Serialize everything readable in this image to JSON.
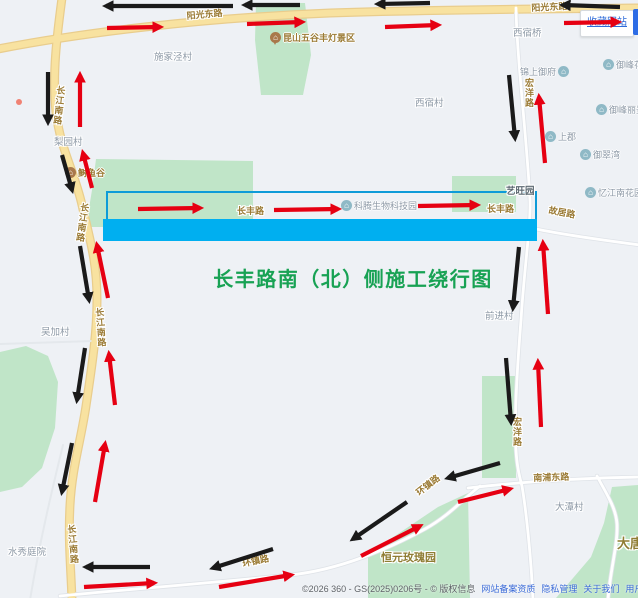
{
  "title": {
    "text": "长丰路南（北）侧施工绕行图"
  },
  "bookmark": {
    "label": "收藏网站"
  },
  "footer": {
    "copyright": "©2026 360 - GS(2025)0206号 - © 版权信息",
    "links": [
      "网站备案资质",
      "隐私管理",
      "关于我们",
      "用户协议",
      "意见反馈"
    ]
  },
  "colors": {
    "bg": "#eef1f5",
    "road_main_fill": "#f8e2a0",
    "road_main_casing": "#e9cd8d",
    "road_minor_fill": "#ffffff",
    "road_minor_casing": "#dfe3e8",
    "road_faint": "#e4e8ec",
    "green_area": "#c0e5c8",
    "highlight_fill": "#00aff0",
    "highlight_outline": "#0e9bd8",
    "arrow_red": "#e60012",
    "arrow_black": "#1a1a1a",
    "road_label": "#9b7b35",
    "village_label": "#8d99a6",
    "brown_label": "#8f7d33",
    "title_green": "#18a254",
    "link_blue": "#3b6bd8",
    "poi_icon": "#8fb9c6",
    "scenic_icon": "#a9784b",
    "red_dot": "#f08273"
  },
  "map": {
    "areas": [
      {
        "points": "256,3 305,3 311,55 303,95 261,95 255,40"
      },
      {
        "points": "96,159 253,161 253,227 86,227 92,190"
      },
      {
        "points": "452,176 516,176 516,212 452,212"
      },
      {
        "points": "0,352 26,346 48,356 58,382 55,428 42,468 22,487 0,492"
      },
      {
        "points": "482,376 516,376 516,478 482,478"
      },
      {
        "points": "368,554 438,507 468,493 470,598 368,598"
      },
      {
        "points": "612,487 638,485 638,598 556,598 591,557 604,523"
      }
    ],
    "roads": [
      {
        "type": "main",
        "d": "M62,-2 C57,35 52,75 56,112 C60,148 74,170 82,205 C90,240 97,262 97,300 C97,335 91,372 86,406 C81,440 72,468 70,505 C68,540 71,570 72,600"
      },
      {
        "type": "main",
        "d": "M-2,49 C80,33 200,18 330,13 C450,9 560,9 640,8"
      },
      {
        "type": "minor",
        "d": "M516,8 C517,60 527,140 530,200 C531,225 524,270 521,320 C517,370 514,420 516,450 C517,468 520,478 522,486 C526,510 531,555 533,600"
      },
      {
        "type": "minor",
        "d": "M536,229 C570,236 610,241 640,245"
      },
      {
        "type": "minor",
        "d": "M468,488 C520,482 580,478 640,477"
      },
      {
        "type": "minor",
        "d": "M60,596 C120,590 200,584 290,575 C340,570 390,548 425,529 C450,515 463,499 480,486"
      },
      {
        "type": "minor",
        "d": "M597,476 C607,495 616,508 617,524 C618,545 610,570 608,600"
      },
      {
        "type": "faint",
        "d": "M63,445 C52,490 40,540 30,600"
      },
      {
        "type": "faint",
        "d": "M0,344 L93,341"
      }
    ],
    "highlight": {
      "outline": {
        "x": 107,
        "y": 192,
        "w": 429,
        "h": 29
      },
      "bar": {
        "x": 103,
        "y": 219,
        "w": 434,
        "h": 22
      }
    },
    "red_dot": {
      "x": 19,
      "y": 102
    },
    "labels": [
      {
        "t": "阳光东路",
        "x": 186,
        "y": 9,
        "type": "road",
        "rot": -5
      },
      {
        "t": "阳光东路",
        "x": 531,
        "y": 1,
        "type": "road",
        "rot": -3
      },
      {
        "t": "长江南路",
        "x": 55,
        "y": 85,
        "type": "road",
        "v": true,
        "rot": 6
      },
      {
        "t": "长江南路",
        "x": 79,
        "y": 202,
        "type": "road",
        "v": true,
        "rot": 8
      },
      {
        "t": "长江南路",
        "x": 93,
        "y": 308,
        "type": "road",
        "v": true,
        "rot": -4
      },
      {
        "t": "长江南路",
        "x": 65,
        "y": 525,
        "type": "road",
        "v": true,
        "rot": -5
      },
      {
        "t": "长丰路",
        "x": 237,
        "y": 204,
        "type": "road"
      },
      {
        "t": "长丰路",
        "x": 487,
        "y": 202,
        "type": "road"
      },
      {
        "t": "故居路",
        "x": 550,
        "y": 203,
        "type": "road",
        "rot": 11
      },
      {
        "t": "宏洋路",
        "x": 523,
        "y": 78,
        "type": "road",
        "v": true
      },
      {
        "t": "宏洋路",
        "x": 511,
        "y": 417,
        "type": "road",
        "v": true
      },
      {
        "t": "南浦东路",
        "x": 533,
        "y": 471,
        "type": "road",
        "rot": -2
      },
      {
        "t": "环镇路",
        "x": 413,
        "y": 488,
        "type": "road",
        "rot": -38
      },
      {
        "t": "环镇路",
        "x": 241,
        "y": 557,
        "type": "road",
        "rot": -12
      },
      {
        "t": "施家泾村",
        "x": 154,
        "y": 49,
        "type": "village"
      },
      {
        "t": "梨园村",
        "x": 54,
        "y": 134,
        "type": "village"
      },
      {
        "t": "西宿桥",
        "x": 513,
        "y": 25,
        "type": "village"
      },
      {
        "t": "西宿村",
        "x": 415,
        "y": 95,
        "type": "village"
      },
      {
        "t": "吴加村",
        "x": 41,
        "y": 324,
        "type": "village"
      },
      {
        "t": "前进村",
        "x": 485,
        "y": 308,
        "type": "village"
      },
      {
        "t": "水秀庭院",
        "x": 8,
        "y": 544,
        "type": "village"
      },
      {
        "t": "大潭村",
        "x": 555,
        "y": 499,
        "type": "village"
      },
      {
        "t": "艺旺园",
        "x": 506,
        "y": 183,
        "type": "area"
      },
      {
        "t": "恒元玫瑰园",
        "x": 381,
        "y": 549,
        "type": "brown",
        "s": 11
      },
      {
        "t": "大唐",
        "x": 617,
        "y": 533,
        "type": "brown",
        "s": 13
      }
    ],
    "pois": [
      {
        "t": "锦上御府",
        "x": 520,
        "y": 65,
        "icon": "home",
        "side": "right"
      },
      {
        "t": "御峰花园",
        "x": 603,
        "y": 58,
        "icon": "home"
      },
      {
        "t": "御峰丽景",
        "x": 596,
        "y": 103,
        "icon": "home"
      },
      {
        "t": "上郡",
        "x": 545,
        "y": 130,
        "icon": "home"
      },
      {
        "t": "御翠湾",
        "x": 580,
        "y": 148,
        "icon": "home"
      },
      {
        "t": "忆江南花园",
        "x": 585,
        "y": 186,
        "icon": "home"
      },
      {
        "t": "科腾生物科技园",
        "x": 341,
        "y": 199,
        "icon": "home"
      },
      {
        "t": "昆山五谷丰灯景区",
        "x": 270,
        "y": 31,
        "icon": "scenic"
      },
      {
        "t": "鲥鱼谷",
        "x": 65,
        "y": 166,
        "icon": "scenic"
      }
    ],
    "arrows": [
      {
        "c": "b",
        "x1": 233,
        "y1": 6,
        "x2": 106,
        "y2": 6
      },
      {
        "c": "r",
        "x1": 107,
        "y1": 28,
        "x2": 160,
        "y2": 27
      },
      {
        "c": "b",
        "x1": 300,
        "y1": 5,
        "x2": 245,
        "y2": 5
      },
      {
        "c": "r",
        "x1": 247,
        "y1": 24,
        "x2": 302,
        "y2": 22
      },
      {
        "c": "b",
        "x1": 430,
        "y1": 3,
        "x2": 378,
        "y2": 4
      },
      {
        "c": "r",
        "x1": 385,
        "y1": 27,
        "x2": 438,
        "y2": 25
      },
      {
        "c": "b",
        "x1": 620,
        "y1": 7,
        "x2": 563,
        "y2": 5
      },
      {
        "c": "r",
        "x1": 564,
        "y1": 23,
        "x2": 618,
        "y2": 22
      },
      {
        "c": "b",
        "x1": 48,
        "y1": 72,
        "x2": 48,
        "y2": 122
      },
      {
        "c": "r",
        "x1": 80,
        "y1": 127,
        "x2": 80,
        "y2": 75
      },
      {
        "c": "b",
        "x1": 62,
        "y1": 155,
        "x2": 72,
        "y2": 190
      },
      {
        "c": "r",
        "x1": 92,
        "y1": 188,
        "x2": 83,
        "y2": 153
      },
      {
        "c": "b",
        "x1": 80,
        "y1": 246,
        "x2": 89,
        "y2": 300
      },
      {
        "c": "r",
        "x1": 108,
        "y1": 298,
        "x2": 97,
        "y2": 245
      },
      {
        "c": "b",
        "x1": 85,
        "y1": 348,
        "x2": 77,
        "y2": 400
      },
      {
        "c": "r",
        "x1": 115,
        "y1": 405,
        "x2": 109,
        "y2": 354
      },
      {
        "c": "b",
        "x1": 72,
        "y1": 443,
        "x2": 62,
        "y2": 492
      },
      {
        "c": "r",
        "x1": 95,
        "y1": 502,
        "x2": 105,
        "y2": 444
      },
      {
        "c": "b",
        "x1": 150,
        "y1": 567,
        "x2": 86,
        "y2": 567
      },
      {
        "c": "r",
        "x1": 84,
        "y1": 587,
        "x2": 154,
        "y2": 583
      },
      {
        "c": "b",
        "x1": 273,
        "y1": 549,
        "x2": 213,
        "y2": 568
      },
      {
        "c": "r",
        "x1": 219,
        "y1": 587,
        "x2": 291,
        "y2": 575
      },
      {
        "c": "b",
        "x1": 407,
        "y1": 502,
        "x2": 353,
        "y2": 539
      },
      {
        "c": "r",
        "x1": 361,
        "y1": 556,
        "x2": 420,
        "y2": 526
      },
      {
        "c": "b",
        "x1": 509,
        "y1": 75,
        "x2": 515,
        "y2": 138
      },
      {
        "c": "r",
        "x1": 545,
        "y1": 163,
        "x2": 539,
        "y2": 97
      },
      {
        "c": "b",
        "x1": 519,
        "y1": 247,
        "x2": 513,
        "y2": 308
      },
      {
        "c": "r",
        "x1": 548,
        "y1": 314,
        "x2": 543,
        "y2": 243
      },
      {
        "c": "b",
        "x1": 506,
        "y1": 358,
        "x2": 511,
        "y2": 422
      },
      {
        "c": "r",
        "x1": 541,
        "y1": 427,
        "x2": 538,
        "y2": 362
      },
      {
        "c": "b",
        "x1": 500,
        "y1": 463,
        "x2": 448,
        "y2": 478
      },
      {
        "c": "r",
        "x1": 458,
        "y1": 502,
        "x2": 510,
        "y2": 489
      },
      {
        "c": "r",
        "x1": 138,
        "y1": 209,
        "x2": 200,
        "y2": 208
      },
      {
        "c": "r",
        "x1": 274,
        "y1": 210,
        "x2": 338,
        "y2": 209
      },
      {
        "c": "r",
        "x1": 418,
        "y1": 206,
        "x2": 477,
        "y2": 205
      }
    ]
  }
}
